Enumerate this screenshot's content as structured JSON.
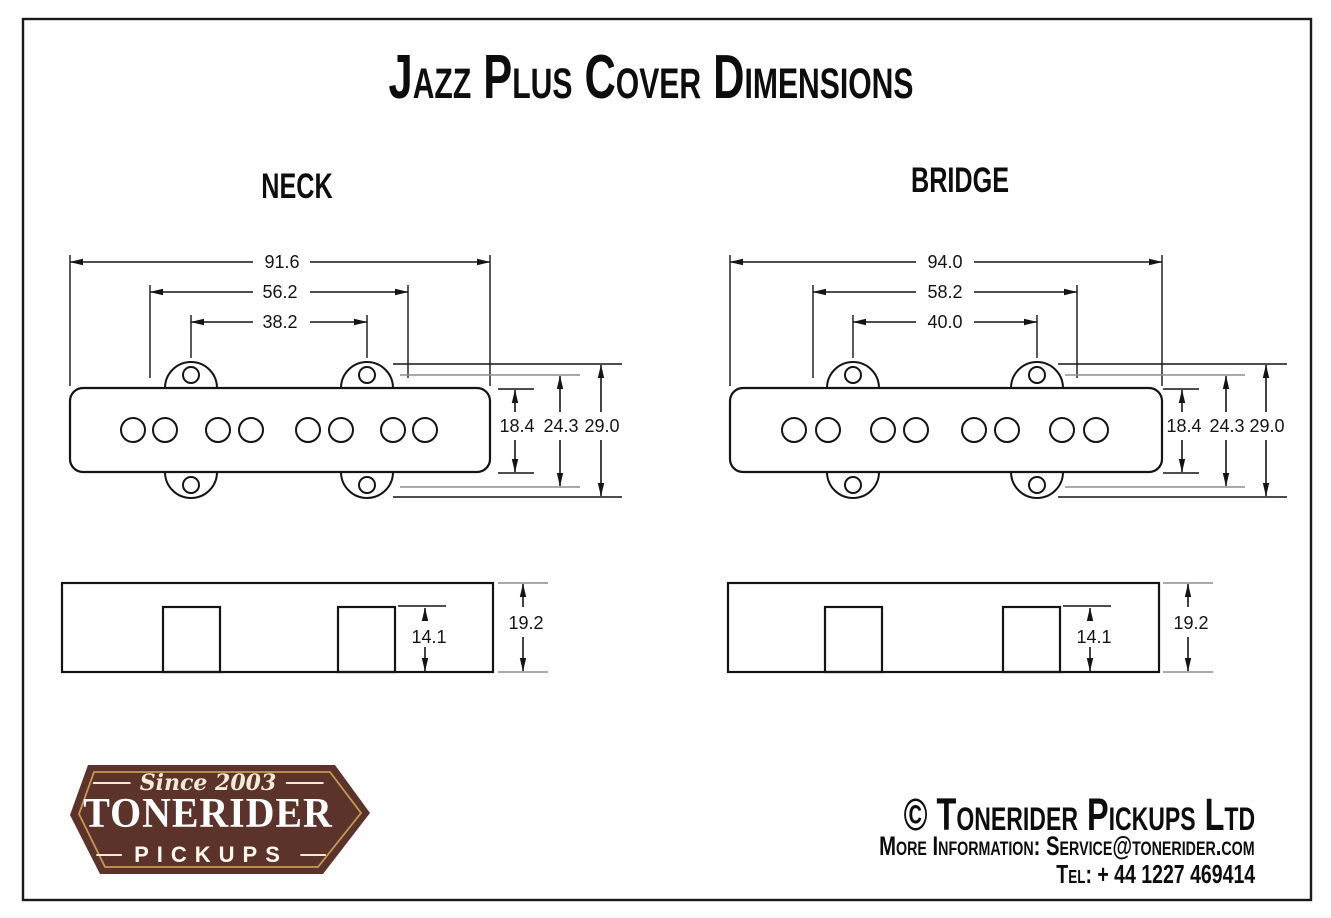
{
  "title": "Jazz Plus Cover Dimensions",
  "neck": {
    "label": "NECK",
    "top_view": {
      "overall_width_mm": "91.6",
      "mount_hole_span_outer_mm": "56.2",
      "mount_hole_span_inner_mm": "38.2",
      "cover_body_depth_mm": "18.4",
      "flange_depth_mm": "24.3",
      "overall_depth_mm": "29.0"
    },
    "side_view": {
      "lug_height_mm": "14.1",
      "overall_height_mm": "19.2"
    }
  },
  "bridge": {
    "label": "BRIDGE",
    "top_view": {
      "overall_width_mm": "94.0",
      "mount_hole_span_outer_mm": "58.2",
      "mount_hole_span_inner_mm": "40.0",
      "cover_body_depth_mm": "18.4",
      "flange_depth_mm": "24.3",
      "overall_depth_mm": "29.0"
    },
    "side_view": {
      "lug_height_mm": "14.1",
      "overall_height_mm": "19.2"
    }
  },
  "footer": {
    "badge": {
      "tagline": "Since 2003",
      "brand": "TONERIDER",
      "word": "PICKUPS"
    },
    "copyright": "© Tonerider Pickups Ltd",
    "info": "More Information: Service@tonerider.com",
    "phone": "Tel: + 44 1227 469414"
  },
  "colors": {
    "line": "#141414",
    "reference_gray": "#8e8e8e",
    "badge_brown": "#5b332b",
    "badge_gold": "#c49a52",
    "badge_cream": "#f2e9d6"
  }
}
